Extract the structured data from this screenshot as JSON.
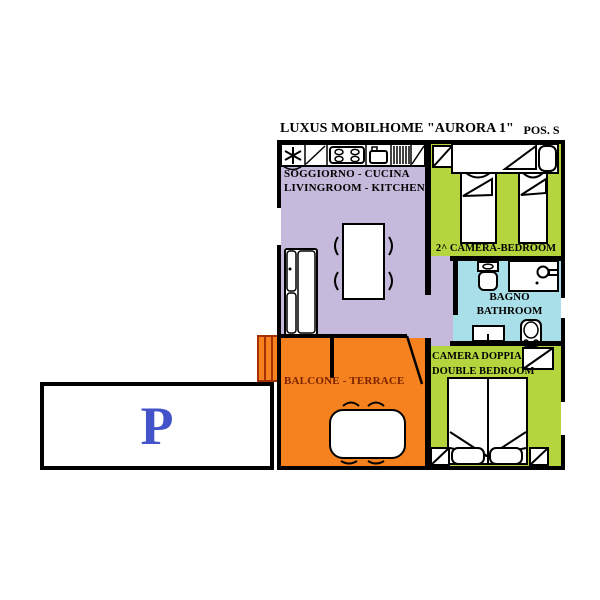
{
  "title": "LUXUS MOBILHOME \"AURORA 1\"",
  "position_label": "POS. S",
  "rooms": {
    "living_kitchen": {
      "name_it": "SOGGIORNO - CUCINA",
      "name_en": "LIVINGROOM - KITCHEN",
      "fill": "#C6BADC"
    },
    "second_bedroom": {
      "label": "2^ CAMERA-BEDROOM",
      "fill": "#B5D53E"
    },
    "bathroom": {
      "name_it": "BAGNO",
      "name_en": "BATHROOM",
      "fill": "#A9DFE9"
    },
    "double_bedroom": {
      "name_it": "CAMERA DOPPIA",
      "name_en": "DOUBLE BEDROOM",
      "fill": "#B5D53E"
    },
    "terrace": {
      "label": "BALCONE - TERRACE",
      "fill": "#F5821E",
      "label_color": "#7B2200"
    },
    "hallway": {
      "fill": "#C6BADC"
    }
  },
  "parking": {
    "label": "P",
    "label_color": "#4353C9",
    "fill": "#FFFFFF"
  },
  "wall_color": "#000000",
  "furniture_icons": {
    "kitchen": [
      "ceiling-fan",
      "worktop",
      "stove",
      "sink",
      "refrigerator"
    ],
    "living": [
      "sofa",
      "dining-table",
      "chairs"
    ],
    "second_bedroom": [
      "wardrobe",
      "bed-top",
      "single-bed-left",
      "single-bed-right"
    ],
    "bathroom": [
      "toilet",
      "shower",
      "washbasin",
      "bidet"
    ],
    "double_bedroom": [
      "wardrobe",
      "double-bed",
      "pillows",
      "nightstand-left",
      "nightstand-right"
    ],
    "terrace": [
      "entrance-steps",
      "entrance-door",
      "table",
      "chairs"
    ]
  }
}
